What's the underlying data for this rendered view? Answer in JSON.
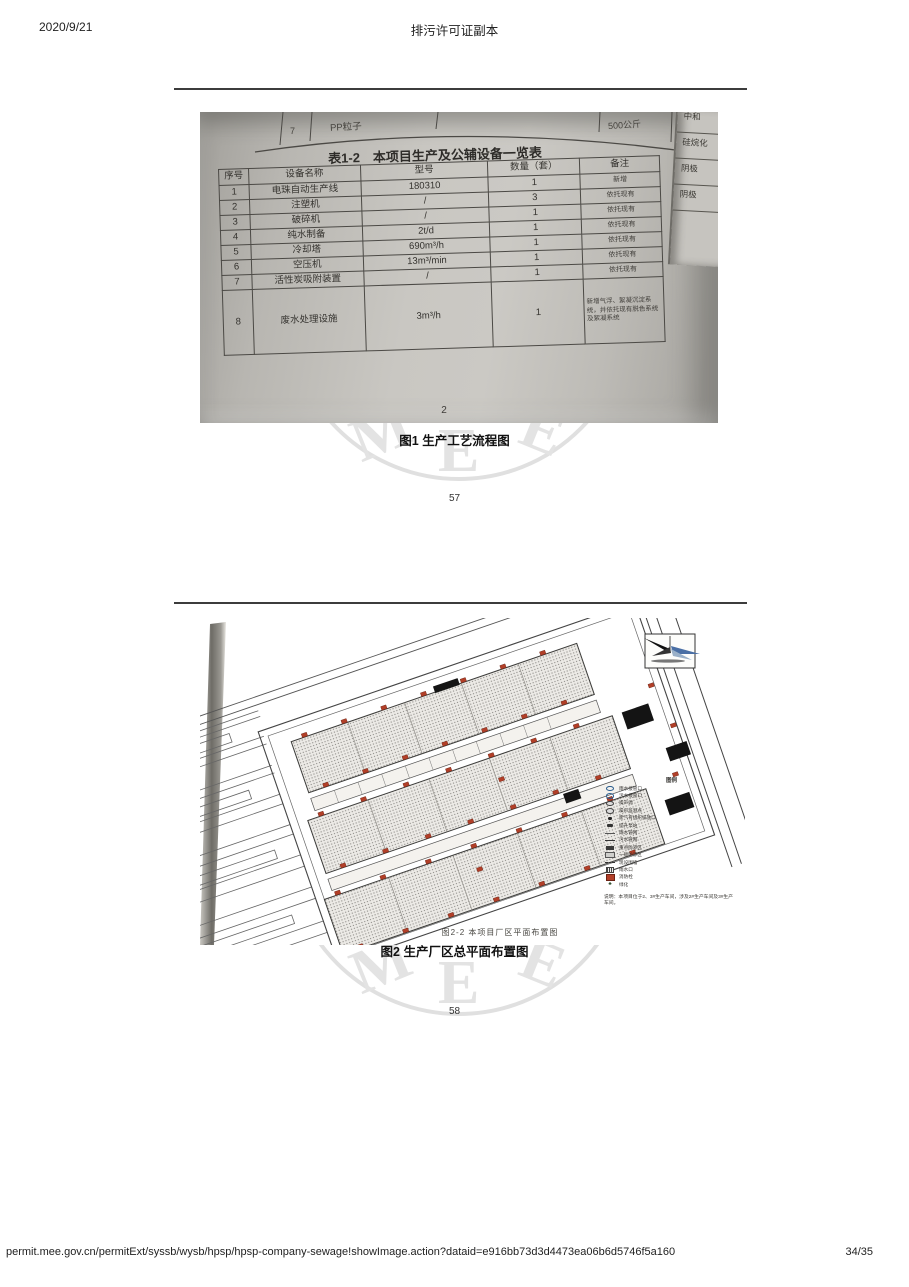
{
  "header": {
    "date": "2020/9/21",
    "title": "排污许可证副本"
  },
  "footer": {
    "url": "permit.mee.gov.cn/permitExt/syssb/wysb/hpsp/hpsp-company-sewage!showImage.action?dataid=e916bb73d3d4473ea06b6d5746f5a160",
    "page_indicator": "34/35"
  },
  "watermark": {
    "letters": [
      "M",
      "E",
      "E"
    ]
  },
  "figure1": {
    "caption": "图1 生产工艺流程图",
    "page_number_below": "57",
    "photo": {
      "doc_page_number": "2",
      "partial_top_row": {
        "no": "7",
        "name": "PP粒子",
        "value": "500公斤"
      },
      "side_page_fragments": [
        "中和",
        "硅烷化",
        "阴极",
        "阴极"
      ],
      "table": {
        "title": "表1-2　本项目生产及公辅设备一览表",
        "headers": [
          "序号",
          "设备名称",
          "型号",
          "数量（套）",
          "备注"
        ],
        "rows": [
          [
            "1",
            "电珠自动生产线",
            "180310",
            "1",
            "新增"
          ],
          [
            "2",
            "注塑机",
            "/",
            "3",
            "依托现有"
          ],
          [
            "3",
            "破碎机",
            "/",
            "1",
            "依托现有"
          ],
          [
            "4",
            "纯水制备",
            "2t/d",
            "1",
            "依托现有"
          ],
          [
            "5",
            "冷却塔",
            "690m³/h",
            "1",
            "依托现有"
          ],
          [
            "6",
            "空压机",
            "13m³/min",
            "1",
            "依托现有"
          ],
          [
            "7",
            "活性炭吸附装置",
            "/",
            "1",
            "依托现有"
          ],
          [
            "8",
            "废水处理设施",
            "3m³/h",
            "1",
            "新增气浮、絮凝沉淀系统，并依托现有脱色系统及絮凝系统"
          ]
        ]
      }
    }
  },
  "figure2": {
    "caption": "图2  生产厂区总平面布置图",
    "page_number_below": "58",
    "photo": {
      "plan_caption": "图2-2  本项目厂区平面布置图",
      "legend": {
        "title": "图例",
        "items": [
          "雨水接管口",
          "污水接管口",
          "噪声源",
          "噪声监测点",
          "废气有组织排放口",
          "提升泵站",
          "雨水管网",
          "污水管网",
          "重点防渗区",
          "一般防渗区",
          "现设围墙",
          "雨水口",
          "消防栓",
          "绿化"
        ]
      },
      "note": "说明：本项目位于2、3#生产车间，涉及2#生产车间及3#生产车间。",
      "colors": {
        "marker_red": "#b23f28",
        "compass_blue": "#4a6fa5"
      }
    }
  }
}
